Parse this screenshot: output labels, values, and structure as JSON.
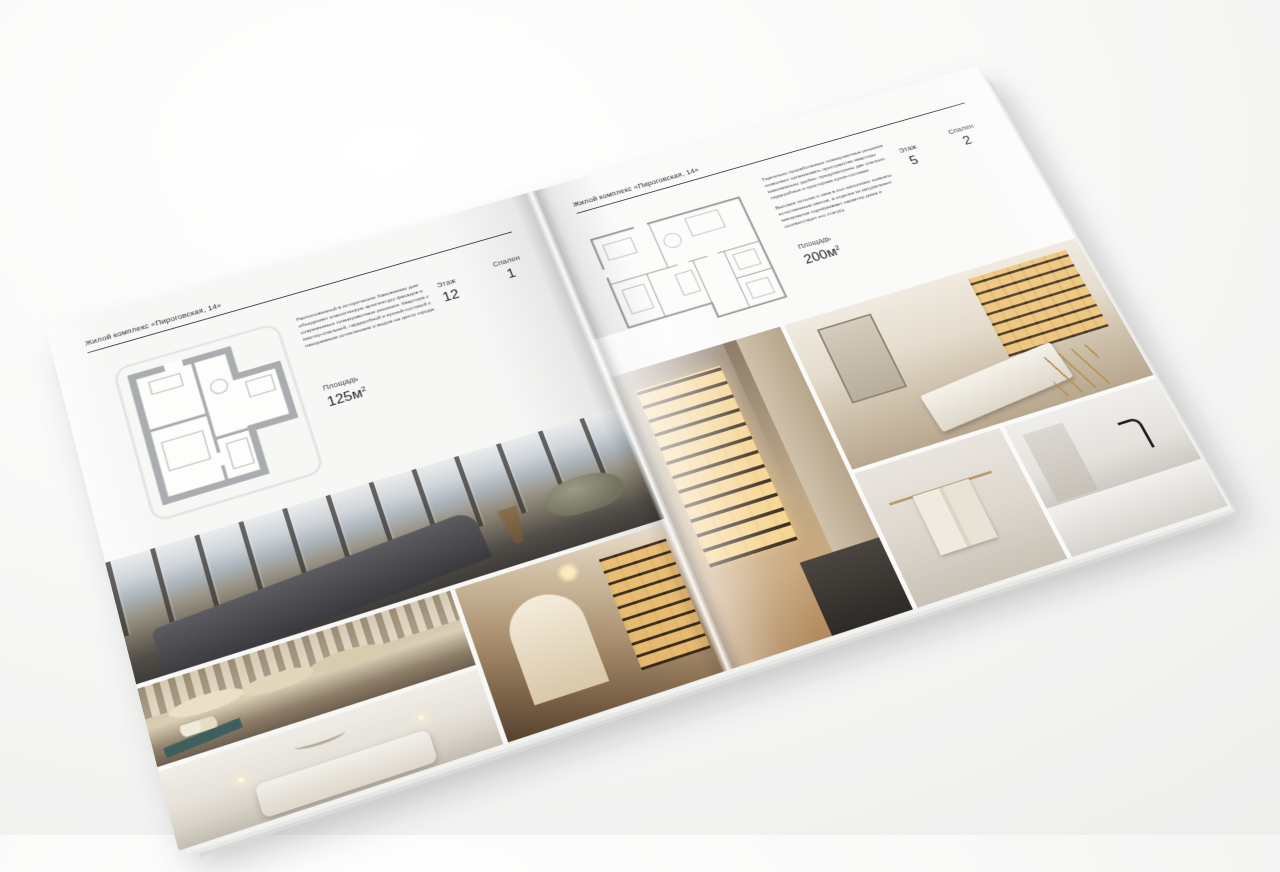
{
  "brochure": {
    "left_page": {
      "header": "Жилой комплекс «Пироговская, 14»",
      "description": "Расположенный в исторических Хамовниках дом объединяет классическую архитектуру фасадов и современные планировочные решения. Квартира с мастер-спальней, гардеробной и кухней-гостиной с панорамным остеклением и видом на центр города.",
      "specs": {
        "area": {
          "label": "Площадь",
          "value": "125м",
          "sup": "2"
        },
        "floor": {
          "label": "Этаж",
          "value": "12"
        },
        "bedrooms": {
          "label": "Спален",
          "value": "1"
        }
      },
      "floor_plan": {
        "title": "Планировка квартиры с одной спальней",
        "wall_color": "#a9adb0"
      },
      "photos": [
        {
          "name": "bedroom-panorama",
          "subject": "Спальня с панорамными окнами и видом на город",
          "palette": [
            "#c7ccd2",
            "#8e8579",
            "#46464a"
          ]
        },
        {
          "name": "bedroom-classic",
          "subject": "Спальня в классическом стиле с подушками",
          "palette": [
            "#d3c6ae",
            "#b5a489",
            "#3e5f5e"
          ]
        },
        {
          "name": "hallway-library",
          "subject": "Холл с подсвеченными стеллажами и аркой",
          "palette": [
            "#cdbb9f",
            "#e0bc7c",
            "#55412d"
          ]
        },
        {
          "name": "bedroom-white",
          "subject": "Светлая спальня с банкеткой",
          "palette": [
            "#efece6",
            "#d8d3c9",
            "#c2bcb0"
          ]
        }
      ]
    },
    "right_page": {
      "header": "Жилой комплекс «Пироговская, 14»",
      "description_1": "Тщательно проработанные планировочные решения позволяют организовать пространство квартиры максимально удобно: предусмотрены две спальни, гардеробные и просторная кухня-гостиная.",
      "description_2": "Высокие потолки и окна в пол наполняют комнаты естественным светом, а отделка из натуральных материалов подчёркивает характер дома и соответствует его статусу.",
      "specs": {
        "area": {
          "label": "Площадь",
          "value": "200м",
          "sup": "2"
        },
        "floor": {
          "label": "Этаж",
          "value": "5"
        },
        "bedrooms": {
          "label": "Спален",
          "value": "2"
        }
      },
      "floor_plan": {
        "title": "Планировка квартиры с двумя спальнями",
        "line_color": "#9b9b99"
      },
      "photos": [
        {
          "name": "dressing-room",
          "subject": "Гардеробная с подсвеченными витринами",
          "palette": [
            "#bfa988",
            "#fad68e",
            "#33261a"
          ]
        },
        {
          "name": "cabinet-study",
          "subject": "Кабинет с витриной, зеркалом и кушеткой на золотых опорах",
          "palette": [
            "#e4dccd",
            "#c9a96a",
            "#b8934f"
          ]
        },
        {
          "name": "bathroom-towel",
          "subject": "Ванная комната, полотенцедержатель",
          "palette": [
            "#e8e4dd",
            "#b79a6d"
          ]
        },
        {
          "name": "bathroom-vanity",
          "subject": "Ванная комната с чёрным смесителем",
          "palette": [
            "#efedea",
            "#1f1f1f"
          ]
        }
      ]
    }
  }
}
